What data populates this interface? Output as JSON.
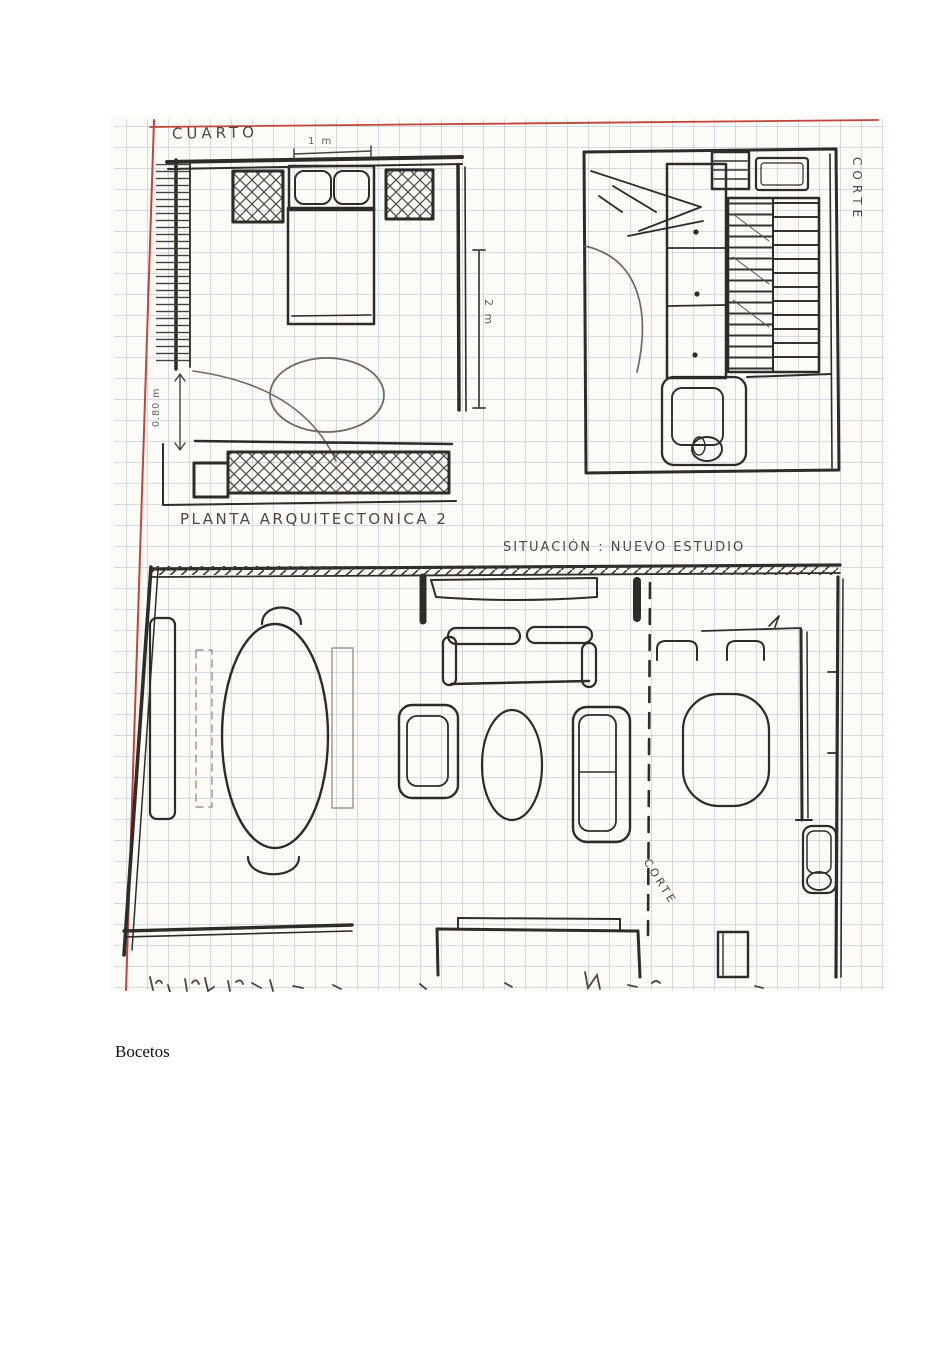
{
  "page": {
    "background": "#ffffff",
    "caption": "Bocetos"
  },
  "scan": {
    "description": "hand-drawn architectural floor plan sketches on graph paper",
    "colors": {
      "paper": "#fcfbf8",
      "grid": "#a8b8cb",
      "ink": "#2e2c28",
      "pencil": "#6e6a61",
      "margin_line": "#c2443a"
    },
    "labels": {
      "room_title": "CUARTO",
      "plan_title": "PLANTA ARQUITECTONICA 2",
      "situation_title": "SITUACIÓN : NUEVO ESTUDIO",
      "section_label_top": "CORTE",
      "section_label_bottom": "CORTE",
      "dim_width": "1 m",
      "dim_height": "2 m",
      "dim_door": "0.80 m"
    }
  }
}
